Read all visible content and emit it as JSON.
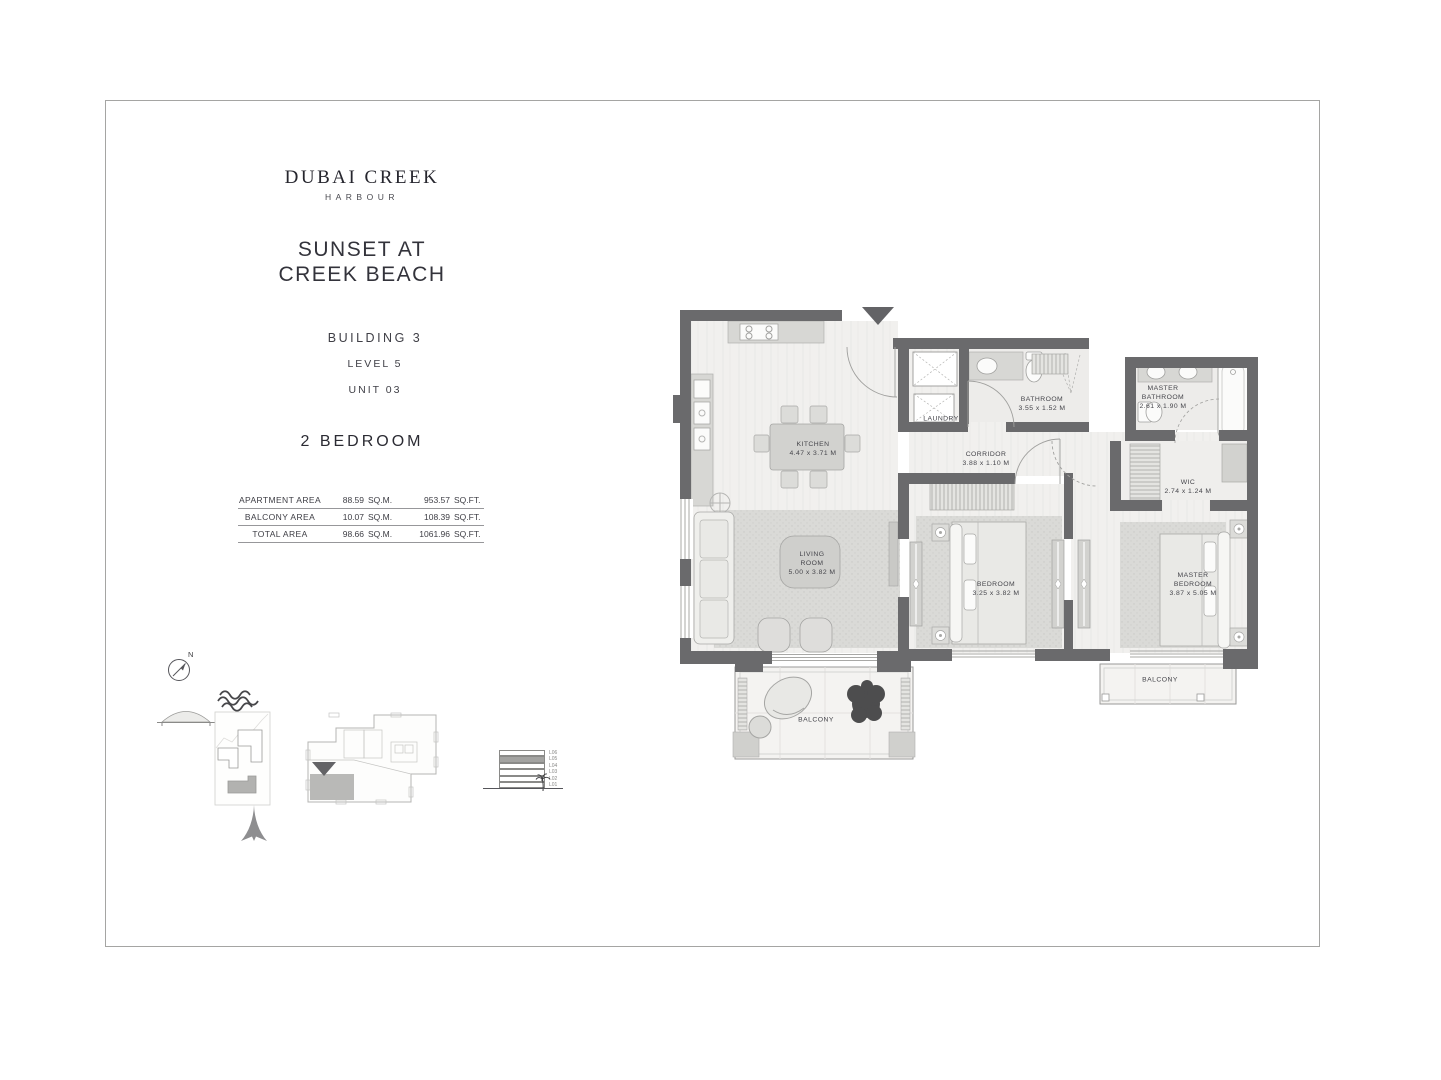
{
  "brand": {
    "title": "DUBAI CREEK",
    "subtitle": "HARBOUR"
  },
  "project": {
    "title_lines": [
      "SUNSET AT",
      "CREEK BEACH"
    ]
  },
  "unit": {
    "building": "BUILDING 3",
    "level": "LEVEL 5",
    "unit": "UNIT 03",
    "type": "2 BEDROOM"
  },
  "area_table": {
    "rows": [
      {
        "label": "APARTMENT AREA",
        "sqm": "88.59",
        "sqm_unit": "SQ.M.",
        "sqft": "953.57",
        "sqft_unit": "SQ.FT."
      },
      {
        "label": "BALCONY AREA",
        "sqm": "10.07",
        "sqm_unit": "SQ.M.",
        "sqft": "108.39",
        "sqft_unit": "SQ.FT."
      },
      {
        "label": "TOTAL AREA",
        "sqm": "98.66",
        "sqm_unit": "SQ.M.",
        "sqft": "1061.96",
        "sqft_unit": "SQ.FT."
      }
    ]
  },
  "compass": {
    "label": "N"
  },
  "levels": {
    "labels": [
      "L06",
      "L05",
      "L04",
      "L03",
      "L02",
      "L01"
    ],
    "highlighted": "L05"
  },
  "floorplan": {
    "rooms": {
      "kitchen": [
        "KITCHEN",
        "4.47 x 3.71 M"
      ],
      "living_room": [
        "LIVING",
        "ROOM",
        "5.00 x 3.82 M"
      ],
      "bedroom": [
        "BEDROOM",
        "3.25 x 3.82 M"
      ],
      "master_bedroom": [
        "MASTER",
        "BEDROOM",
        "3.87 x 5.05 M"
      ],
      "bathroom": [
        "BATHROOM",
        "3.55 x 1.52 M"
      ],
      "master_bathroom": [
        "MASTER",
        "BATHROOM",
        "2.61 x 1.90 M"
      ],
      "corridor": [
        "CORRIDOR",
        "3.88 x 1.10 M"
      ],
      "wic": [
        "WIC",
        "2.74 x 1.24 M"
      ],
      "laundry": [
        "LAUNDRY"
      ],
      "balcony_main": [
        "BALCONY"
      ],
      "balcony_master": [
        "BALCONY"
      ]
    },
    "colors": {
      "wall": "#6a6a6c",
      "floor": "#f1f0ee",
      "rug": "#dadad7",
      "fixture": "#d7d7d4"
    }
  }
}
